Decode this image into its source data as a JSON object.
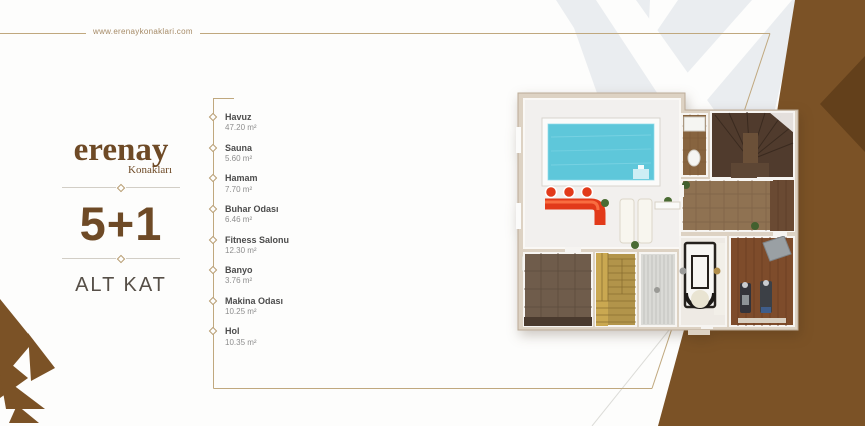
{
  "header": {
    "website": "www.erenaykonaklari.com"
  },
  "brand": {
    "logo": "erenay",
    "logo_sub": "Konakları",
    "unit": "5+1",
    "floor": "ALT KAT"
  },
  "room_list": [
    {
      "name": "Havuz",
      "area": "47.20 m²"
    },
    {
      "name": "Sauna",
      "area": "5.60 m²"
    },
    {
      "name": "Hamam",
      "area": "7.70 m²"
    },
    {
      "name": "Buhar Odası",
      "area": "6.46 m²"
    },
    {
      "name": "Fitness Salonu",
      "area": "12.30 m²"
    },
    {
      "name": "Banyo",
      "area": "3.76 m²"
    },
    {
      "name": "Makina Odası",
      "area": "10.25 m²"
    },
    {
      "name": "Hol",
      "area": "10.35 m²"
    }
  ],
  "floorplan": {
    "rooms": [
      "havuz",
      "sauna",
      "hamam",
      "buhar-odasi",
      "fitness-salonu",
      "banyo",
      "makina-odasi",
      "hol",
      "merdiven",
      "wc"
    ]
  },
  "colors": {
    "accent_brown": "#7b5226",
    "accent_brown_dark": "#63401b",
    "logo_brown": "#6e4a26",
    "frame_line": "#bfa57d",
    "pool_water": "#5ec7da",
    "bar_red": "#e23a1a"
  }
}
